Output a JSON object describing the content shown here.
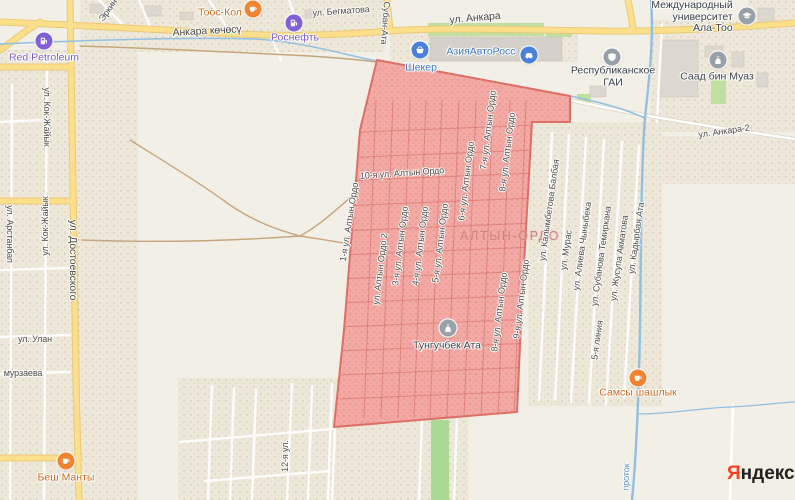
{
  "colors": {
    "background": "#f2efe6",
    "region_fill": "#f2a5a1",
    "region_border": "#dd6f66",
    "road_yellow": "#fcdf8a",
    "road_yellow_casing": "#e9c97a",
    "road_white": "#ffffff",
    "water": "#93bfe2",
    "dirt_road": "#c5a67e",
    "green_area": "#bfe0a0",
    "poi_food": "#ef8432",
    "poi_gas": "#8161d8",
    "poi_shop": "#4a80d9",
    "poi_gray": "#99a1a8",
    "street_text": "#4c4a45",
    "district_text": "#c98585",
    "yandex_red": "#fc3f1d"
  },
  "attribution": {
    "brand_ya": "Я",
    "brand_rest": "ндекс"
  },
  "map": {
    "region": {
      "points": "377,60 570,96 570,122 532,122 522,300 517,412 334,427 344,330 360,130",
      "fill": "#f2a5a1",
      "border": "#dd6f66"
    },
    "labels": [
      {
        "name": "street-ankara-kochosu",
        "text": "Анкара көчөсү",
        "x": 207,
        "y": 31,
        "rot": -3,
        "cls": "street-lg"
      },
      {
        "name": "street-begmatova",
        "text": "ул. Бегматова",
        "x": 341,
        "y": 11,
        "rot": -4,
        "cls": "street"
      },
      {
        "name": "street-ankara",
        "text": "ул. Анкара",
        "x": 475,
        "y": 18,
        "rot": -5,
        "cls": "street-lg"
      },
      {
        "name": "street-suban-ata",
        "text": "ул. Субан-Ата",
        "x": 386,
        "y": 16,
        "rot": 94,
        "cls": "street"
      },
      {
        "name": "street-erkin",
        "text": "Эркин",
        "x": 108,
        "y": 10,
        "rot": -55,
        "cls": "street"
      },
      {
        "name": "street-ankara-2",
        "text": "ул. Анкара-2",
        "x": 724,
        "y": 131,
        "rot": -8,
        "cls": "street"
      },
      {
        "name": "street-dostoevskogo",
        "text": "ул. Достоевского",
        "x": 73,
        "y": 260,
        "rot": 90,
        "cls": "street-lg"
      },
      {
        "name": "street-kok-zhaiyk-1",
        "text": "ул. Кок-Жайык",
        "x": 47,
        "y": 117,
        "rot": 90,
        "cls": "street"
      },
      {
        "name": "street-kok-zhaiyk-2",
        "text": "ул. Кок-Жайык",
        "x": 45,
        "y": 226,
        "rot": -90,
        "cls": "street"
      },
      {
        "name": "street-arstanbap",
        "text": "ул. Арстанбап",
        "x": 10,
        "y": 234,
        "rot": 90,
        "cls": "street"
      },
      {
        "name": "street-ulan",
        "text": "ул. Улан",
        "x": 35,
        "y": 339,
        "rot": 0,
        "cls": "street"
      },
      {
        "name": "street-murzaeva",
        "text": "мурзаева",
        "x": 23,
        "y": 373,
        "rot": 0,
        "cls": "street"
      },
      {
        "name": "street-12ya",
        "text": "12-я ул.",
        "x": 285,
        "y": 456,
        "rot": -90,
        "cls": "street"
      },
      {
        "name": "street-1ya-altyn-ordo",
        "text": "1-я ул. Алтын Ордо",
        "x": 349,
        "y": 222,
        "rot": -81,
        "cls": "street"
      },
      {
        "name": "street-altyn-ordo-2",
        "text": "ул. Алтын Ордо 2",
        "x": 380,
        "y": 269,
        "rot": -83,
        "cls": "street"
      },
      {
        "name": "street-3ya-altyn-ordo",
        "text": "3-я ул. Алтын Ордо",
        "x": 400,
        "y": 246,
        "rot": -83,
        "cls": "street"
      },
      {
        "name": "street-4ya-altyn-ordo",
        "text": "4-я ул. Алтын Ордо",
        "x": 420,
        "y": 246,
        "rot": -83,
        "cls": "street"
      },
      {
        "name": "street-5ya-altyn-ordo",
        "text": "5-я ул. Алтын Ордо",
        "x": 440,
        "y": 243,
        "rot": -83,
        "cls": "street"
      },
      {
        "name": "street-6ya-altyn-ordo",
        "text": "6-я ул. Алтын Ордо",
        "x": 466,
        "y": 181,
        "rot": -83,
        "cls": "street"
      },
      {
        "name": "street-7ya-altyn-ordo",
        "text": "7-я ул. Алтын Ордо",
        "x": 488,
        "y": 130,
        "rot": -83,
        "cls": "street"
      },
      {
        "name": "street-8ya-altyn-ordo-n",
        "text": "8-я ул. Алтын Ордо",
        "x": 507,
        "y": 152,
        "rot": -83,
        "cls": "street"
      },
      {
        "name": "street-8ya-altyn-ordo-s",
        "text": "8-я ул. Алтын Ордо",
        "x": 499,
        "y": 312,
        "rot": -83,
        "cls": "street"
      },
      {
        "name": "street-9ya-altyn-ordo",
        "text": "9-я ул. Алтын Ордо",
        "x": 521,
        "y": 299,
        "rot": -83,
        "cls": "street"
      },
      {
        "name": "street-10ya-altyn-ordo",
        "text": "10-я ул. Алтын Ордо",
        "x": 402,
        "y": 173,
        "rot": -4,
        "cls": "street"
      },
      {
        "name": "district-altyn-ordo",
        "text": "АЛТЫН-ОРДО",
        "x": 510,
        "y": 236,
        "rot": 0,
        "cls": "district"
      },
      {
        "name": "street-kalymbetova-balbaya",
        "text": "ул. Калымбетова Балбая",
        "x": 549,
        "y": 210,
        "rot": -82,
        "cls": "street"
      },
      {
        "name": "street-muras",
        "text": "ул. Мурас",
        "x": 566,
        "y": 250,
        "rot": -82,
        "cls": "street"
      },
      {
        "name": "street-alieva-chynybeka",
        "text": "ул. Алиева Чыныбека",
        "x": 582,
        "y": 246,
        "rot": -82,
        "cls": "street"
      },
      {
        "name": "street-subanova-temirkana",
        "text": "ул. Субанова Темиркана",
        "x": 601,
        "y": 256,
        "rot": -82,
        "cls": "street"
      },
      {
        "name": "street-5ya-liniya",
        "text": "5-я линия",
        "x": 597,
        "y": 340,
        "rot": -82,
        "cls": "street"
      },
      {
        "name": "street-zhusupa-akmatova",
        "text": "ул. Жусупа Акматова",
        "x": 619,
        "y": 258,
        "rot": -82,
        "cls": "street"
      },
      {
        "name": "street-kadyrbaya-ata",
        "text": "ул. Кадырбая Ата",
        "x": 636,
        "y": 238,
        "rot": -82,
        "cls": "street"
      },
      {
        "name": "water-protok",
        "text": "проток",
        "x": 626,
        "y": 477,
        "rot": -88,
        "cls": "water-label"
      }
    ],
    "pois": [
      {
        "icon": "food",
        "name": "toos-kol",
        "cx": 253,
        "cy": 9,
        "lx": 220,
        "ly": 13,
        "cls": "food",
        "lines": [
          "Тоос-Кол"
        ]
      },
      {
        "icon": "gas",
        "name": "rosneft",
        "cx": 294,
        "cy": 23,
        "lx": 295,
        "ly": 38,
        "cls": "gas",
        "lines": [
          "Роснефть"
        ]
      },
      {
        "icon": "gas",
        "name": "red-petroleum",
        "cx": 44,
        "cy": 41,
        "lx": 44,
        "ly": 58,
        "cls": "gas",
        "lines": [
          "Red Petroleum"
        ]
      },
      {
        "icon": "basket",
        "name": "sheker",
        "cx": 420,
        "cy": 50,
        "lx": 421,
        "ly": 68,
        "cls": "shop",
        "lines": [
          "Шекер"
        ]
      },
      {
        "icon": "car",
        "name": "aziya-avtoross",
        "cx": 529,
        "cy": 55,
        "lx": 481,
        "ly": 52,
        "cls": "shop",
        "lines": [
          "АзияАвтоРосс"
        ]
      },
      {
        "icon": "shield",
        "name": "respublikanskoe-gai",
        "cx": 612,
        "cy": 57,
        "lx": 613,
        "ly": 77,
        "cls": "gray",
        "lines": [
          "Республиканское",
          "ГАИ"
        ]
      },
      {
        "icon": "university",
        "name": "ala-too-university",
        "cx": 747,
        "cy": 16,
        "lx": 692,
        "ly": 17,
        "cls": "gray align-right",
        "lines": [
          "Международный",
          "университет",
          "Ала-Тоо"
        ]
      },
      {
        "icon": "mosque",
        "name": "saad-bin-muaz",
        "cx": 718,
        "cy": 60,
        "lx": 717,
        "ly": 77,
        "cls": "gray",
        "lines": [
          "Саад бин Муаз"
        ]
      },
      {
        "icon": "mosque",
        "name": "tunguchbek-ata",
        "cx": 448,
        "cy": 328,
        "lx": 447,
        "ly": 346,
        "cls": "gray",
        "lines": [
          "Тунгучбек Ата"
        ]
      },
      {
        "icon": "food",
        "name": "samsy-shashlyk",
        "cx": 638,
        "cy": 378,
        "lx": 638,
        "ly": 393,
        "cls": "food",
        "lines": [
          "Самсы шашлык"
        ]
      },
      {
        "icon": "food",
        "name": "besh-manty",
        "cx": 66,
        "cy": 461,
        "lx": 66,
        "ly": 478,
        "cls": "food",
        "lines": [
          "Беш Манты"
        ]
      }
    ]
  }
}
